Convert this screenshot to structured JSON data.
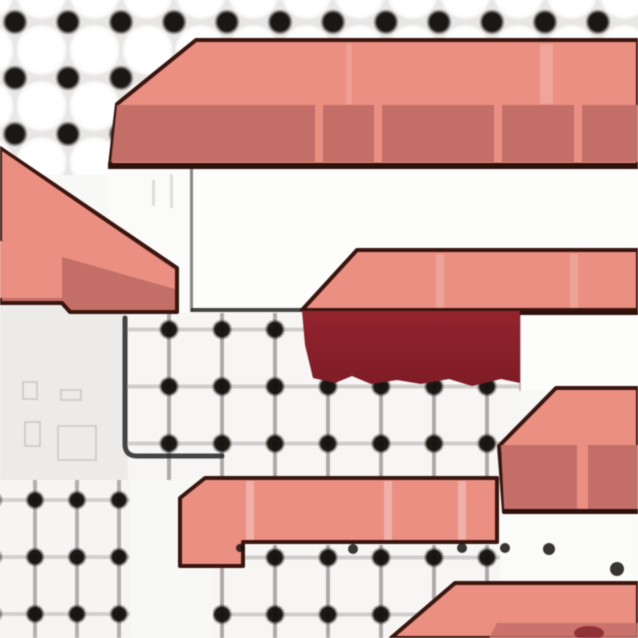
{
  "app": {
    "name": "game-map-view",
    "view": "zoomed overworld scene"
  },
  "palette": {
    "roof_light": "#ea8f82",
    "roof_shade": "#c46e68",
    "maroon_top": "#93242e",
    "maroon_bottom": "#7e1c26",
    "outline": "#3a150e",
    "edge_dark": "#2e110b",
    "wall": "#fdfdfc",
    "wall_edge": "#3a3a3a",
    "ledge": "#262626",
    "dot": "#17130f",
    "stripe_glint": "#ffffff"
  },
  "scene": {
    "ground": {
      "tile_dot_color": "#17130f",
      "tile_face_color": "#ffffff",
      "plaza_color": "#ecebe9"
    },
    "structures": [
      {
        "id": "building-north",
        "parts": [
          "roof-upper-band",
          "roof-lower-band",
          "roof-seam-stripes",
          "front-wall"
        ]
      },
      {
        "id": "building-west",
        "parts": [
          "sloped-roof",
          "light-band",
          "highlight-panel"
        ]
      },
      {
        "id": "building-mid",
        "parts": [
          "salmon-roof-band",
          "maroon-awning",
          "side-wall"
        ]
      },
      {
        "id": "awning-band-south",
        "parts": [
          "salmon-band",
          "seam-stripes"
        ]
      },
      {
        "id": "building-southeast",
        "parts": [
          "sloped-roof",
          "light-band",
          "shade-band",
          "seam-stripe"
        ]
      },
      {
        "id": "building-bottom",
        "parts": [
          "sloped-roof",
          "shade-edge",
          "dark-blotch"
        ]
      },
      {
        "id": "plaza-ledge",
        "parts": [
          "l-shaped-edge-line"
        ]
      }
    ]
  }
}
